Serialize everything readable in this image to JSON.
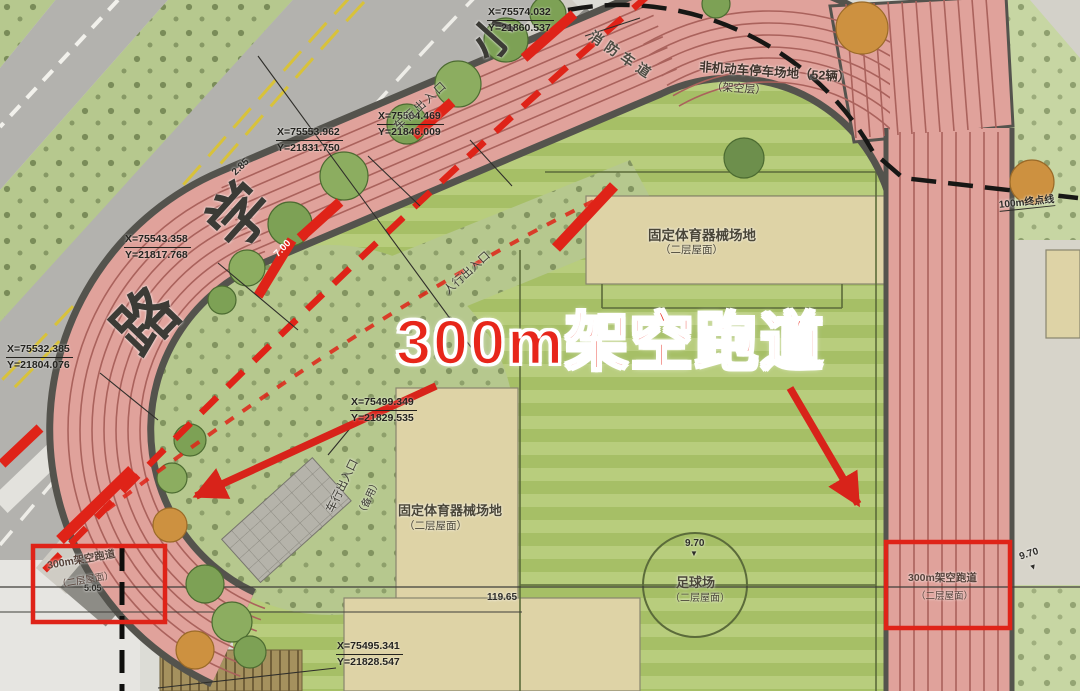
{
  "title": {
    "text": "300m架空跑道"
  },
  "road": {
    "name_chars": [
      "小",
      "学",
      "路"
    ]
  },
  "callouts": [
    {
      "x": "X=75574.032",
      "y": "Y=21860.537"
    },
    {
      "x": "X=75564.469",
      "y": "Y=21846.009"
    },
    {
      "x": "X=75553.962",
      "y": "Y=21831.750"
    },
    {
      "x": "X=75543.358",
      "y": "Y=21817.768"
    },
    {
      "x": "X=75532.385",
      "y": "Y=21804.076"
    },
    {
      "x": "X=75499.349",
      "y": "Y=21829.535"
    },
    {
      "x": "X=75495.341",
      "y": "Y=21828.547"
    }
  ],
  "labels": {
    "fire_lane": "消防车道",
    "vehicle_entrance": "车行出入口",
    "vehicle_entrance_note": "（备用）",
    "pedestrian_entrance": "人行出入口",
    "bike_parking": "非机动车停车场地（52辆）",
    "bike_parking_sub": "（架空层）",
    "equipment_area": "固定体育器械场地",
    "level_note": "（二层屋面）",
    "soccer_field": "足球场",
    "track_box": "300m架空跑道",
    "finish_line": "100m终点线"
  },
  "dimensions": {
    "road_offset": "2.85",
    "road_width": "7.00",
    "field_length": "119.65",
    "elevation": "9.70",
    "track_width": "5.05"
  },
  "markers": {
    "down_triangle": "▼"
  },
  "colors": {
    "accent_red": "#e02318",
    "track_pink": "#e0a29b",
    "field_green": "#aac46b",
    "tan": "#ded3a6"
  }
}
